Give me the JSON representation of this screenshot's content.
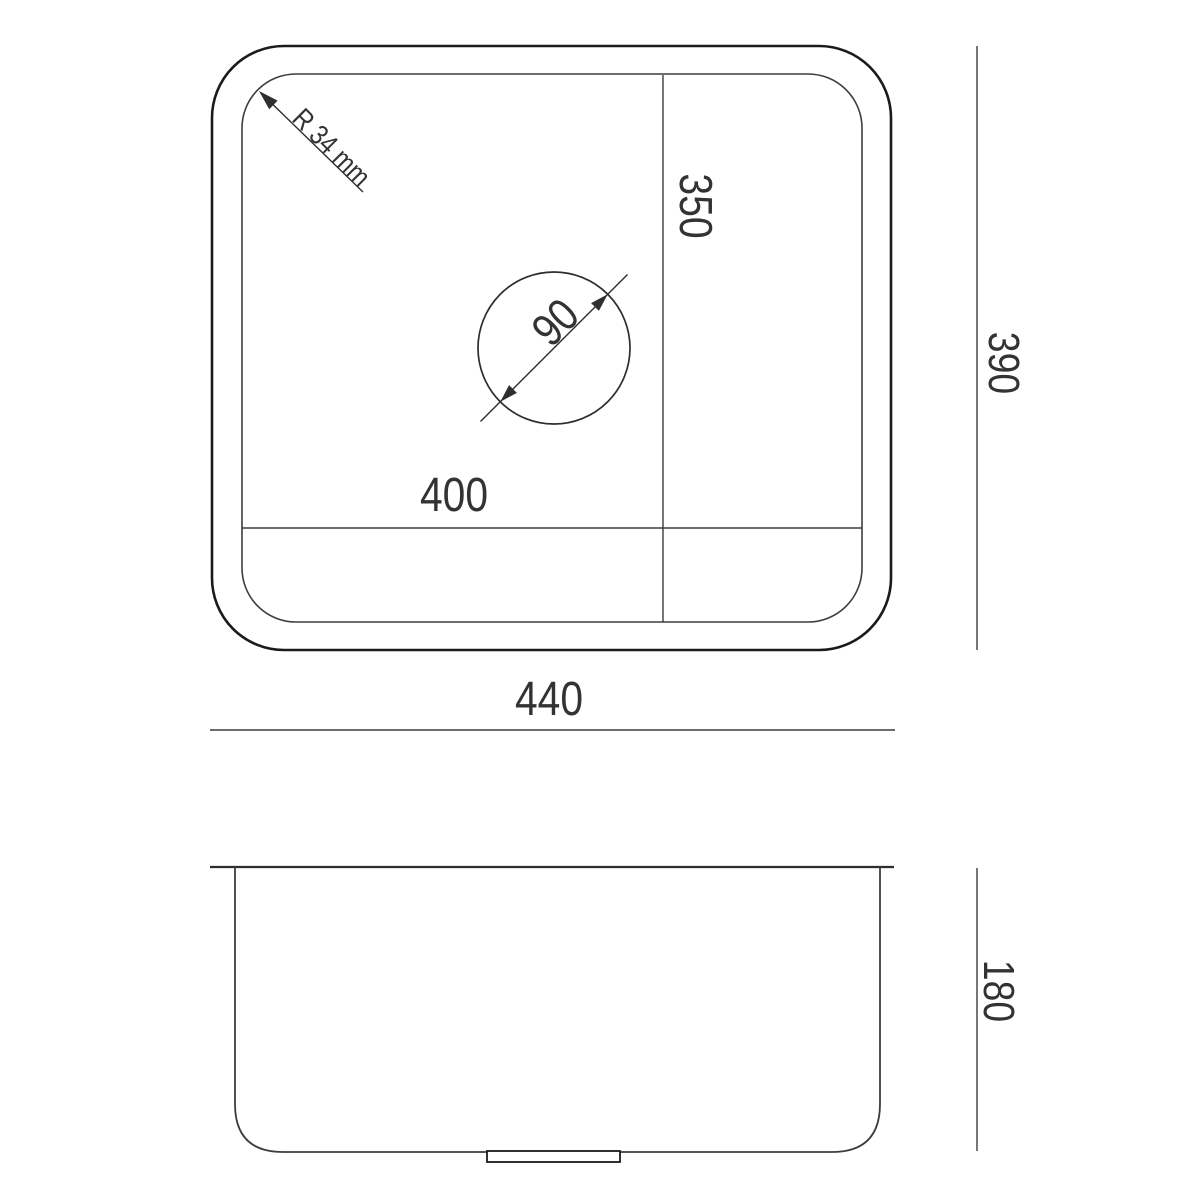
{
  "figure": {
    "type": "technical-drawing",
    "subject": "rectangular undermount sink dimension diagram",
    "views": {
      "top": {
        "outer_width_label": "440",
        "outer_height_label": "390",
        "basin_width_label": "400",
        "basin_height_label": "350",
        "drain_diameter_label": "90",
        "corner_radius_label": "R 34 mm"
      },
      "side": {
        "depth_label": "180"
      }
    },
    "colors": {
      "background": "#ffffff",
      "line_heavy": "#1b1b1b",
      "line_light": "#3d3d3d",
      "text": "#333333"
    }
  }
}
